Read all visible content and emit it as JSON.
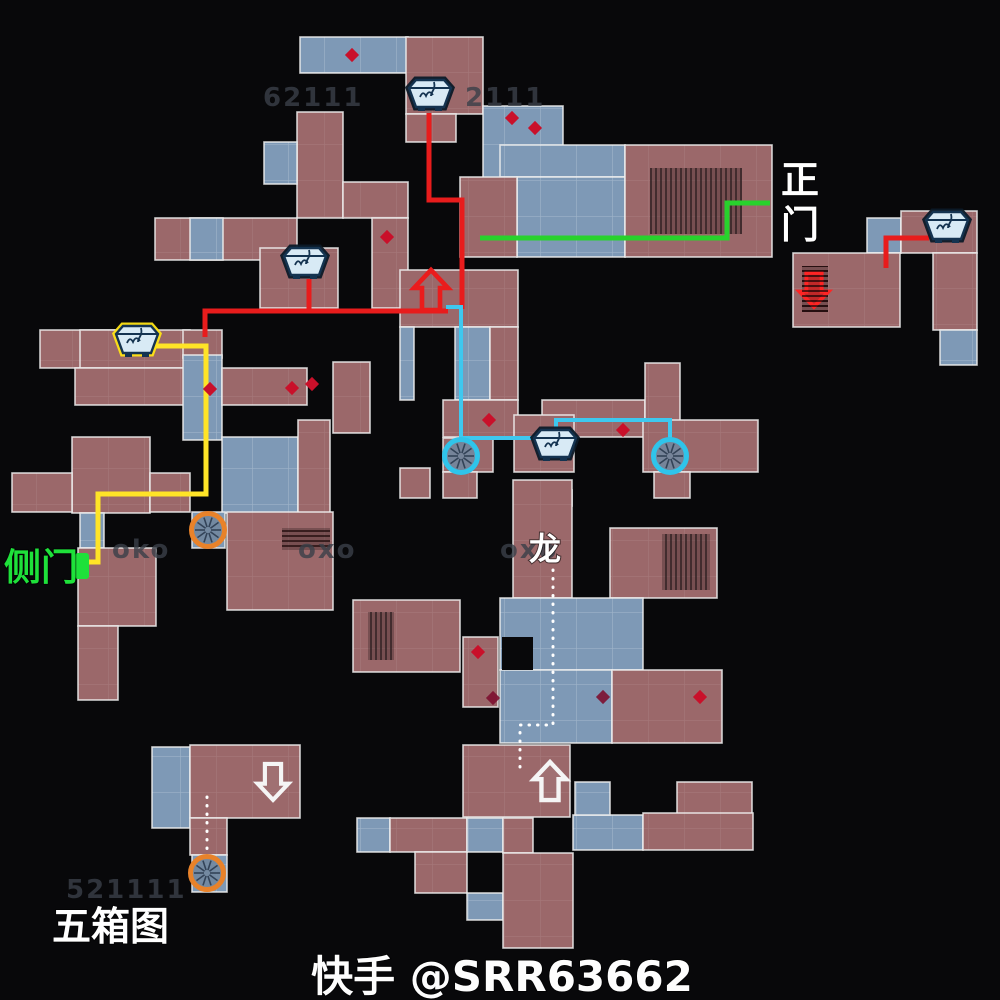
{
  "page": {
    "width": 1000,
    "height": 1000,
    "background": "#08080a",
    "title": "五箱图"
  },
  "legend": {
    "main_gate": "正门",
    "side_gate": "侧门",
    "dragon": "龙",
    "map_title": "五箱图",
    "watermark": "快手 @SRR63662"
  },
  "map": {
    "colors": {
      "room_red": "#9b686a",
      "room_blue": "#7e99b6",
      "wall": "rgba(238,238,238,0.85)",
      "red_route": "#e81c1c",
      "green_route": "#28d22c",
      "yellow_route": "#ffe427",
      "cyan_route": "#3ec8ef",
      "orange_ring": "#e8822a",
      "cyan_ring": "#2fc4ea",
      "diamond": "#c9102a",
      "diamond_dark": "#7d1030",
      "crate_fill": "#d8eaf5",
      "crate_line": "#143350",
      "crate_highlight": "#ffe415",
      "gate_green": "#1ee13a"
    },
    "rooms": [
      [
        300,
        37,
        108,
        36,
        "b"
      ],
      [
        406,
        37,
        77,
        77,
        "r"
      ],
      [
        406,
        114,
        50,
        28,
        "r"
      ],
      [
        483,
        106,
        80,
        77,
        "b"
      ],
      [
        297,
        112,
        46,
        106,
        "r"
      ],
      [
        264,
        142,
        33,
        42,
        "b"
      ],
      [
        343,
        182,
        65,
        36,
        "r"
      ],
      [
        155,
        218,
        142,
        42,
        "r"
      ],
      [
        190,
        218,
        33,
        42,
        "b"
      ],
      [
        260,
        248,
        78,
        60,
        "r"
      ],
      [
        372,
        218,
        36,
        90,
        "r"
      ],
      [
        333,
        362,
        37,
        71,
        "r"
      ],
      [
        500,
        145,
        125,
        32,
        "b"
      ],
      [
        517,
        177,
        108,
        80,
        "b"
      ],
      [
        460,
        177,
        57,
        80,
        "r"
      ],
      [
        625,
        145,
        147,
        112,
        "r"
      ],
      [
        400,
        270,
        118,
        57,
        "r"
      ],
      [
        455,
        327,
        35,
        73,
        "b"
      ],
      [
        490,
        327,
        28,
        73,
        "r"
      ],
      [
        400,
        327,
        14,
        73,
        "b"
      ],
      [
        443,
        400,
        75,
        37,
        "r"
      ],
      [
        542,
        400,
        103,
        37,
        "r"
      ],
      [
        645,
        363,
        35,
        75,
        "r"
      ],
      [
        643,
        420,
        115,
        52,
        "r"
      ],
      [
        514,
        415,
        60,
        57,
        "r"
      ],
      [
        443,
        438,
        50,
        34,
        "r"
      ],
      [
        443,
        472,
        34,
        26,
        "r"
      ],
      [
        514,
        490,
        58,
        16,
        "r"
      ],
      [
        654,
        472,
        36,
        26,
        "r"
      ],
      [
        400,
        468,
        30,
        30,
        "r"
      ],
      [
        40,
        330,
        75,
        38,
        "r"
      ],
      [
        80,
        330,
        110,
        38,
        "r"
      ],
      [
        75,
        368,
        115,
        37,
        "r"
      ],
      [
        183,
        330,
        39,
        28,
        "r"
      ],
      [
        183,
        355,
        39,
        85,
        "b"
      ],
      [
        222,
        368,
        85,
        37,
        "r"
      ],
      [
        72,
        437,
        78,
        76,
        "r"
      ],
      [
        12,
        473,
        60,
        39,
        "r"
      ],
      [
        150,
        473,
        40,
        39,
        "r"
      ],
      [
        222,
        437,
        76,
        76,
        "b"
      ],
      [
        298,
        420,
        32,
        93,
        "r"
      ],
      [
        192,
        512,
        33,
        36,
        "b"
      ],
      [
        227,
        512,
        106,
        98,
        "r"
      ],
      [
        80,
        513,
        24,
        35,
        "b"
      ],
      [
        78,
        548,
        78,
        78,
        "r"
      ],
      [
        78,
        626,
        40,
        74,
        "r"
      ],
      [
        513,
        480,
        59,
        118,
        "r"
      ],
      [
        610,
        528,
        107,
        70,
        "r"
      ],
      [
        353,
        600,
        107,
        72,
        "r"
      ],
      [
        463,
        637,
        35,
        70,
        "r"
      ],
      [
        500,
        598,
        143,
        72,
        "b"
      ],
      [
        500,
        670,
        112,
        73,
        "b"
      ],
      [
        612,
        670,
        110,
        73,
        "r"
      ],
      [
        463,
        745,
        107,
        72,
        "r"
      ],
      [
        357,
        818,
        33,
        34,
        "b"
      ],
      [
        390,
        818,
        77,
        34,
        "r"
      ],
      [
        415,
        852,
        52,
        41,
        "r"
      ],
      [
        467,
        818,
        36,
        34,
        "b"
      ],
      [
        503,
        818,
        30,
        35,
        "r"
      ],
      [
        467,
        893,
        36,
        27,
        "b"
      ],
      [
        503,
        853,
        70,
        95,
        "r"
      ],
      [
        573,
        815,
        70,
        35,
        "b"
      ],
      [
        575,
        782,
        35,
        33,
        "b"
      ],
      [
        677,
        782,
        75,
        33,
        "r"
      ],
      [
        643,
        813,
        110,
        37,
        "r"
      ],
      [
        152,
        747,
        38,
        81,
        "b"
      ],
      [
        190,
        745,
        110,
        73,
        "r"
      ],
      [
        190,
        818,
        37,
        37,
        "r"
      ],
      [
        192,
        855,
        35,
        37,
        "b"
      ],
      [
        867,
        218,
        34,
        35,
        "b"
      ],
      [
        901,
        211,
        76,
        42,
        "r"
      ],
      [
        793,
        253,
        107,
        74,
        "r"
      ],
      [
        933,
        253,
        44,
        77,
        "r"
      ],
      [
        940,
        330,
        37,
        35,
        "b"
      ]
    ],
    "notches": [
      [
        502,
        637,
        31,
        33
      ]
    ],
    "hatches": [
      {
        "x": 650,
        "y": 168,
        "w": 92,
        "h": 66,
        "o": "v"
      },
      {
        "x": 802,
        "y": 266,
        "w": 26,
        "h": 46,
        "o": "h"
      },
      {
        "x": 662,
        "y": 534,
        "w": 48,
        "h": 56,
        "o": "v"
      },
      {
        "x": 368,
        "y": 612,
        "w": 26,
        "h": 48,
        "o": "v"
      },
      {
        "x": 282,
        "y": 528,
        "w": 48,
        "h": 22,
        "o": "h"
      }
    ],
    "diamonds": [
      [
        352,
        55
      ],
      [
        512,
        118
      ],
      [
        535,
        128
      ],
      [
        387,
        237
      ],
      [
        210,
        389
      ],
      [
        292,
        388
      ],
      [
        312,
        384
      ],
      [
        489,
        420
      ],
      [
        623,
        430
      ],
      [
        478,
        652
      ],
      [
        603,
        697,
        1
      ],
      [
        700,
        697
      ],
      [
        493,
        698,
        1
      ]
    ],
    "routes": [
      {
        "name": "red-route-main",
        "color": "#e81c1c",
        "w": 5,
        "pts": [
          [
            429,
            113
          ],
          [
            429,
            200
          ],
          [
            462,
            200
          ],
          [
            462,
            309
          ]
        ]
      },
      {
        "name": "red-route-west",
        "color": "#e81c1c",
        "w": 5,
        "pts": [
          [
            205,
            337
          ],
          [
            205,
            311
          ],
          [
            448,
            311
          ]
        ]
      },
      {
        "name": "red-route-crate-b",
        "color": "#e81c1c",
        "w": 5,
        "pts": [
          [
            309,
            279
          ],
          [
            309,
            311
          ]
        ]
      },
      {
        "name": "red-route-northeast",
        "color": "#e81c1c",
        "w": 5,
        "pts": [
          [
            929,
            238
          ],
          [
            886,
            238
          ],
          [
            886,
            268
          ]
        ]
      },
      {
        "name": "green-route-main-gate",
        "color": "#28d22c",
        "w": 5,
        "pts": [
          [
            480,
            238
          ],
          [
            727,
            238
          ],
          [
            727,
            203
          ],
          [
            770,
            203
          ]
        ]
      },
      {
        "name": "yellow-route-side-gate",
        "color": "#ffe427",
        "w": 5,
        "pts": [
          [
            155,
            346
          ],
          [
            206,
            346
          ],
          [
            206,
            494
          ],
          [
            98,
            494
          ],
          [
            98,
            562
          ],
          [
            88,
            562
          ]
        ]
      },
      {
        "name": "cyan-route-a",
        "color": "#3ec8ef",
        "w": 4,
        "pts": [
          [
            446,
            307
          ],
          [
            461,
            307
          ],
          [
            461,
            438
          ],
          [
            534,
            438
          ]
        ]
      },
      {
        "name": "cyan-route-b",
        "color": "#3ec8ef",
        "w": 4,
        "pts": [
          [
            556,
            429
          ],
          [
            556,
            420
          ],
          [
            670,
            420
          ],
          [
            670,
            441
          ]
        ]
      },
      {
        "name": "white-dotted-route-dragon",
        "color": "#ffffff",
        "w": 3,
        "dash": "0.5 8",
        "cap": "round",
        "pts": [
          [
            553,
            570
          ],
          [
            553,
            725
          ],
          [
            520,
            725
          ],
          [
            520,
            773
          ]
        ]
      },
      {
        "name": "white-dotted-route-southwest",
        "color": "#ffffff",
        "w": 3,
        "dash": "0.5 8",
        "cap": "round",
        "pts": [
          [
            207,
            797
          ],
          [
            207,
            851
          ]
        ]
      }
    ],
    "arrows": [
      {
        "name": "red-up-arrow",
        "x": 431,
        "y": 291,
        "dir": "up",
        "stroke": "#ea1c1c",
        "fill": "none",
        "s": 1.0
      },
      {
        "name": "red-down-arrow",
        "x": 814,
        "y": 289,
        "dir": "down",
        "stroke": "#ff2424",
        "fill": "rgba(220,25,25,0.72)",
        "s": 0.85
      },
      {
        "name": "white-up-arrow",
        "x": 550,
        "y": 782,
        "dir": "up",
        "stroke": "#f5f5f5",
        "fill": "rgba(255,255,255,0.06)",
        "s": 0.95
      },
      {
        "name": "white-down-arrow",
        "x": 273,
        "y": 781,
        "dir": "down",
        "stroke": "#f5f5f5",
        "fill": "rgba(255,255,255,0.06)",
        "s": 0.9
      }
    ],
    "fans": [
      {
        "x": 461,
        "y": 456,
        "ring": "cyan_ring"
      },
      {
        "x": 670,
        "y": 456,
        "ring": "cyan_ring"
      },
      {
        "x": 208,
        "y": 530,
        "ring": "orange_ring"
      },
      {
        "x": 207,
        "y": 873,
        "ring": "orange_ring"
      }
    ],
    "crates": [
      {
        "x": 430,
        "y": 94,
        "hl": false
      },
      {
        "x": 305,
        "y": 262,
        "hl": false
      },
      {
        "x": 137,
        "y": 340,
        "hl": true
      },
      {
        "x": 555,
        "y": 444,
        "hl": false
      },
      {
        "x": 947,
        "y": 226,
        "hl": false
      }
    ],
    "gate_marker": {
      "x": 75,
      "y": 553,
      "w": 14,
      "h": 26
    },
    "labels": [
      {
        "id": "main-gate",
        "text": "正门",
        "x": 800,
        "y": 193,
        "size": 38,
        "color": "#ffffff",
        "anchor": "middle",
        "vertical": true
      },
      {
        "id": "side-gate",
        "text": "侧门",
        "x": 4,
        "y": 580,
        "size": 37,
        "color": "#1ee13a",
        "anchor": "start"
      },
      {
        "id": "dragon",
        "text": "龙",
        "x": 545,
        "y": 560,
        "size": 32,
        "color": "#ffffff",
        "anchor": "middle"
      },
      {
        "id": "five-box-map",
        "text": "五箱图",
        "x": 52,
        "y": 940,
        "size": 39,
        "color": "#ffffff",
        "anchor": "start"
      },
      {
        "id": "watermark",
        "text": "快手 @SRR63662",
        "x": 502,
        "y": 991,
        "size": 42,
        "color": "#fdfdfd",
        "anchor": "middle"
      }
    ],
    "ghost_labels": [
      {
        "text": "62111",
        "x": 263,
        "y": 106
      },
      {
        "text": "2111",
        "x": 465,
        "y": 106
      },
      {
        "text": "oko",
        "x": 112,
        "y": 558
      },
      {
        "text": "oxo",
        "x": 298,
        "y": 558
      },
      {
        "text": "oxo",
        "x": 500,
        "y": 558
      },
      {
        "text": "521111",
        "x": 66,
        "y": 898
      }
    ]
  }
}
